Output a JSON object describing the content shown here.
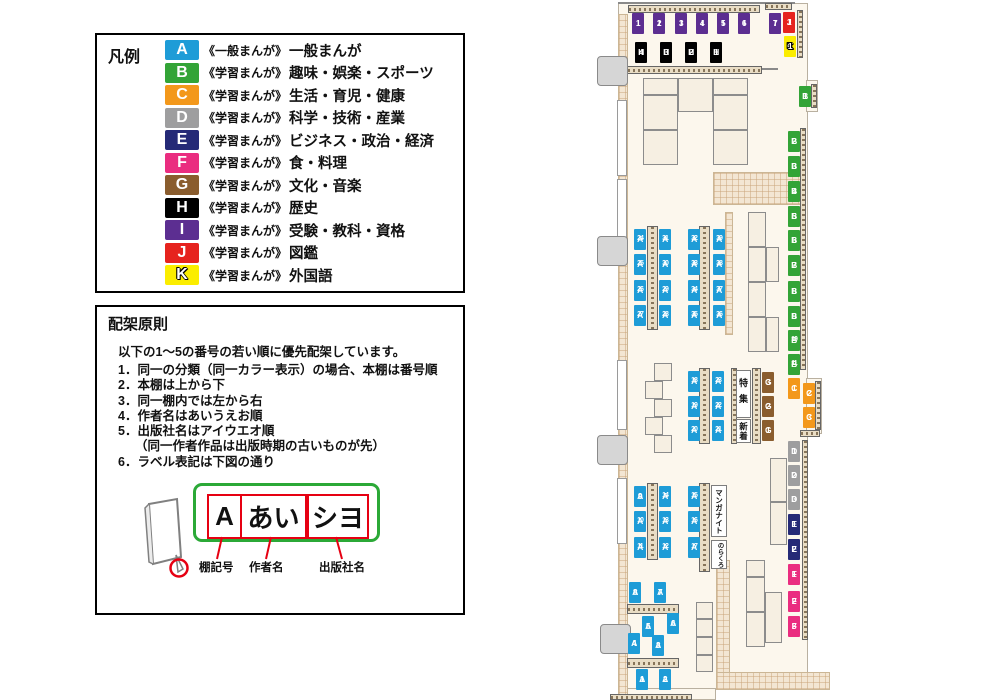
{
  "legend": {
    "title": "凡例",
    "items": [
      {
        "code": "A",
        "color": "#1E9CD7",
        "tag": "《一般まんが》",
        "label": "一般まんが"
      },
      {
        "code": "B",
        "color": "#33A437",
        "tag": "《学習まんが》",
        "label": "趣味・娯楽・スポーツ"
      },
      {
        "code": "C",
        "color": "#F3981B",
        "tag": "《学習まんが》",
        "label": "生活・育児・健康"
      },
      {
        "code": "D",
        "color": "#9E9E9F",
        "tag": "《学習まんが》",
        "label": "科学・技術・産業"
      },
      {
        "code": "E",
        "color": "#252A77",
        "tag": "《学習まんが》",
        "label": "ビジネス・政治・経済"
      },
      {
        "code": "F",
        "color": "#EA2D80",
        "tag": "《学習まんが》",
        "label": "食・料理"
      },
      {
        "code": "G",
        "color": "#8A5D2E",
        "tag": "《学習まんが》",
        "label": "文化・音楽"
      },
      {
        "code": "H",
        "color": "#000000",
        "tag": "《学習まんが》",
        "label": "歴史"
      },
      {
        "code": "I",
        "color": "#5C2E91",
        "tag": "《学習まんが》",
        "label": "受験・教科・資格"
      },
      {
        "code": "J",
        "color": "#E6231E",
        "tag": "《学習まんが》",
        "label": "図鑑"
      },
      {
        "code": "K",
        "color": "#FBED00",
        "tag": "《学習まんが》",
        "label": "外国語"
      }
    ]
  },
  "principles": {
    "title": "配架原則",
    "intro": "以下の1～5の番号の若い順に優先配架しています。",
    "items": [
      {
        "text": "同一の分類（同一カラー表示）の場合、本棚は番号順"
      },
      {
        "text": "本棚は上から下"
      },
      {
        "text": "同一棚内では左から右"
      },
      {
        "text": "作者名はあいうえお順"
      },
      {
        "text": "出版社名はアイウエオ順",
        "sub": "（同一作者作品は出版時期の古いものが先）"
      },
      {
        "text": "ラベル表記は下図の通り"
      }
    ],
    "diagram": {
      "parts": [
        {
          "text": "A",
          "caption": "棚記号"
        },
        {
          "text": "あい",
          "caption": "作者名"
        },
        {
          "text": "シヨ",
          "caption": "出版社名"
        }
      ]
    }
  },
  "map": {
    "colors": {
      "A": "#1E9CD7",
      "B": "#33A437",
      "C": "#F3981B",
      "D": "#9E9E9F",
      "E": "#252A77",
      "F": "#EA2D80",
      "G": "#8A5D2E",
      "H": "#000000",
      "I": "#5C2E91",
      "J": "#E6231E",
      "K": "#FBED00"
    },
    "floors": [
      [
        618,
        3,
        190,
        687
      ],
      [
        618,
        688,
        98,
        12
      ],
      [
        806,
        80,
        12,
        32
      ],
      [
        806,
        378,
        16,
        56
      ]
    ],
    "walls": [
      [
        618,
        14,
        10,
        686
      ],
      [
        713,
        172,
        93,
        33
      ],
      [
        716,
        560,
        14,
        116
      ],
      [
        716,
        672,
        114,
        18
      ],
      [
        725,
        212,
        8,
        123
      ]
    ],
    "strips_v": [
      [
        797,
        10,
        6,
        48
      ],
      [
        811,
        84,
        6,
        24
      ],
      [
        800,
        128,
        6,
        242
      ],
      [
        815,
        381,
        6,
        49
      ],
      [
        802,
        440,
        6,
        200
      ],
      [
        647,
        226,
        11,
        104
      ],
      [
        699,
        226,
        11,
        104
      ],
      [
        699,
        368,
        11,
        76
      ],
      [
        731,
        368,
        6,
        76
      ],
      [
        752,
        368,
        9,
        76
      ],
      [
        647,
        483,
        11,
        77
      ],
      [
        699,
        483,
        11,
        89
      ]
    ],
    "strips_h": [
      [
        628,
        5,
        132,
        8
      ],
      [
        765,
        3,
        27,
        7
      ],
      [
        627,
        66,
        135,
        8
      ],
      [
        800,
        430,
        20,
        7
      ],
      [
        627,
        604,
        52,
        10
      ],
      [
        627,
        658,
        52,
        10
      ],
      [
        610,
        694,
        82,
        6
      ]
    ],
    "cells": [
      [
        643,
        78,
        35,
        17
      ],
      [
        678,
        78,
        35,
        34
      ],
      [
        713,
        78,
        35,
        17
      ],
      [
        643,
        95,
        35,
        35
      ],
      [
        643,
        130,
        35,
        35
      ],
      [
        713,
        95,
        35,
        35
      ],
      [
        713,
        130,
        35,
        35
      ],
      [
        748,
        212,
        18,
        35
      ],
      [
        748,
        247,
        18,
        35
      ],
      [
        748,
        282,
        18,
        35
      ],
      [
        748,
        317,
        18,
        35
      ],
      [
        766,
        247,
        13,
        35
      ],
      [
        766,
        317,
        13,
        35
      ],
      [
        770,
        458,
        17,
        44
      ],
      [
        770,
        502,
        17,
        43
      ],
      [
        746,
        560,
        19,
        17
      ],
      [
        746,
        577,
        19,
        35
      ],
      [
        746,
        612,
        19,
        35
      ],
      [
        765,
        592,
        17,
        51
      ],
      [
        654,
        363,
        18,
        18
      ],
      [
        645,
        381,
        18,
        18
      ],
      [
        654,
        399,
        18,
        18
      ],
      [
        645,
        417,
        18,
        18
      ],
      [
        654,
        435,
        18,
        18
      ],
      [
        696,
        602,
        17,
        17
      ],
      [
        696,
        619,
        17,
        18
      ],
      [
        696,
        637,
        17,
        18
      ],
      [
        696,
        655,
        17,
        17
      ]
    ],
    "windows": [
      [
        617,
        100,
        10,
        76
      ],
      [
        617,
        179,
        10,
        63
      ],
      [
        617,
        360,
        10,
        70
      ],
      [
        617,
        478,
        10,
        66
      ]
    ],
    "doors": [
      [
        597,
        56,
        31,
        30
      ],
      [
        597,
        236,
        31,
        30
      ],
      [
        597,
        435,
        31,
        30
      ],
      [
        600,
        624,
        31,
        30
      ]
    ],
    "lines": [
      [
        618,
        2,
        177,
        2
      ],
      [
        752,
        68,
        26,
        2
      ]
    ],
    "boxes": [
      {
        "text": "特集",
        "x": 736,
        "y": 370,
        "w": 15,
        "h": 48,
        "fs": 9,
        "ls": 7
      },
      {
        "text": "新着",
        "x": 736,
        "y": 419,
        "w": 15,
        "h": 24,
        "fs": 8.5,
        "ls": 1
      },
      {
        "text": "マンガナイト",
        "x": 711,
        "y": 485,
        "w": 16,
        "h": 52,
        "fs": 7.5,
        "ls": 0
      },
      {
        "text": "のらくろ",
        "x": 711,
        "y": 540,
        "w": 16,
        "h": 29,
        "fs": 6.5,
        "ls": 0
      }
    ],
    "labels": [
      {
        "id": "I1",
        "x": 632,
        "y": 13
      },
      {
        "id": "I2",
        "x": 653,
        "y": 13
      },
      {
        "id": "I3",
        "x": 675,
        "y": 13
      },
      {
        "id": "I4",
        "x": 696,
        "y": 13
      },
      {
        "id": "I5",
        "x": 717,
        "y": 13
      },
      {
        "id": "I6",
        "x": 738,
        "y": 13
      },
      {
        "id": "I7",
        "x": 769,
        "y": 13
      },
      {
        "id": "J1",
        "x": 783,
        "y": 12
      },
      {
        "id": "K1",
        "x": 784,
        "y": 36
      },
      {
        "id": "H4",
        "x": 635,
        "y": 42
      },
      {
        "id": "H3",
        "x": 660,
        "y": 42
      },
      {
        "id": "H2",
        "x": 685,
        "y": 42
      },
      {
        "id": "H1",
        "x": 710,
        "y": 42
      },
      {
        "id": "B1",
        "x": 799,
        "y": 86
      },
      {
        "id": "B2",
        "x": 788,
        "y": 131
      },
      {
        "id": "B3",
        "x": 788,
        "y": 156
      },
      {
        "id": "B4",
        "x": 788,
        "y": 181
      },
      {
        "id": "B5",
        "x": 788,
        "y": 206
      },
      {
        "id": "B6",
        "x": 788,
        "y": 230
      },
      {
        "id": "B7",
        "x": 788,
        "y": 255
      },
      {
        "id": "B8",
        "x": 788,
        "y": 281
      },
      {
        "id": "B9",
        "x": 788,
        "y": 306
      },
      {
        "id": "B10",
        "x": 788,
        "y": 330
      },
      {
        "id": "B11",
        "x": 788,
        "y": 354
      },
      {
        "id": "C1",
        "x": 788,
        "y": 378
      },
      {
        "id": "C2",
        "x": 803,
        "y": 383
      },
      {
        "id": "C3",
        "x": 803,
        "y": 407
      },
      {
        "id": "G3",
        "x": 762,
        "y": 372
      },
      {
        "id": "G2",
        "x": 762,
        "y": 396
      },
      {
        "id": "G1",
        "x": 762,
        "y": 420
      },
      {
        "id": "D1",
        "x": 788,
        "y": 441
      },
      {
        "id": "D2",
        "x": 788,
        "y": 465
      },
      {
        "id": "D3",
        "x": 788,
        "y": 489
      },
      {
        "id": "E1",
        "x": 788,
        "y": 514
      },
      {
        "id": "E2",
        "x": 788,
        "y": 539
      },
      {
        "id": "F1",
        "x": 788,
        "y": 564
      },
      {
        "id": "F2",
        "x": 788,
        "y": 591
      },
      {
        "id": "F3",
        "x": 788,
        "y": 616
      },
      {
        "id": "A24",
        "x": 634,
        "y": 229
      },
      {
        "id": "A25",
        "x": 634,
        "y": 254
      },
      {
        "id": "A26",
        "x": 634,
        "y": 280
      },
      {
        "id": "A27",
        "x": 634,
        "y": 305
      },
      {
        "id": "A31",
        "x": 659,
        "y": 229
      },
      {
        "id": "A30",
        "x": 659,
        "y": 254
      },
      {
        "id": "A29",
        "x": 659,
        "y": 280
      },
      {
        "id": "A28",
        "x": 659,
        "y": 305
      },
      {
        "id": "A32",
        "x": 688,
        "y": 229
      },
      {
        "id": "A33",
        "x": 688,
        "y": 254
      },
      {
        "id": "A34",
        "x": 688,
        "y": 280
      },
      {
        "id": "A35",
        "x": 688,
        "y": 305
      },
      {
        "id": "A39",
        "x": 713,
        "y": 229
      },
      {
        "id": "A38",
        "x": 713,
        "y": 254
      },
      {
        "id": "A37",
        "x": 713,
        "y": 280
      },
      {
        "id": "A36",
        "x": 713,
        "y": 305
      },
      {
        "id": "A18",
        "x": 688,
        "y": 371
      },
      {
        "id": "A19",
        "x": 688,
        "y": 396
      },
      {
        "id": "A20",
        "x": 688,
        "y": 420
      },
      {
        "id": "A23",
        "x": 712,
        "y": 371
      },
      {
        "id": "A22",
        "x": 712,
        "y": 396
      },
      {
        "id": "A21",
        "x": 712,
        "y": 420
      },
      {
        "id": "A9",
        "x": 634,
        "y": 486
      },
      {
        "id": "A10",
        "x": 634,
        "y": 511
      },
      {
        "id": "A11",
        "x": 634,
        "y": 537
      },
      {
        "id": "A14",
        "x": 659,
        "y": 486
      },
      {
        "id": "A13",
        "x": 659,
        "y": 511
      },
      {
        "id": "A12",
        "x": 659,
        "y": 537
      },
      {
        "id": "A15",
        "x": 688,
        "y": 486
      },
      {
        "id": "A16",
        "x": 688,
        "y": 511
      },
      {
        "id": "A17",
        "x": 688,
        "y": 537
      },
      {
        "id": "A8",
        "x": 629,
        "y": 582
      },
      {
        "id": "A7",
        "x": 654,
        "y": 582
      },
      {
        "id": "A5",
        "x": 642,
        "y": 616
      },
      {
        "id": "A6",
        "x": 667,
        "y": 613
      },
      {
        "id": "A4",
        "x": 628,
        "y": 633
      },
      {
        "id": "A3",
        "x": 652,
        "y": 635
      },
      {
        "id": "A1",
        "x": 636,
        "y": 669
      },
      {
        "id": "A2",
        "x": 659,
        "y": 669
      }
    ]
  }
}
